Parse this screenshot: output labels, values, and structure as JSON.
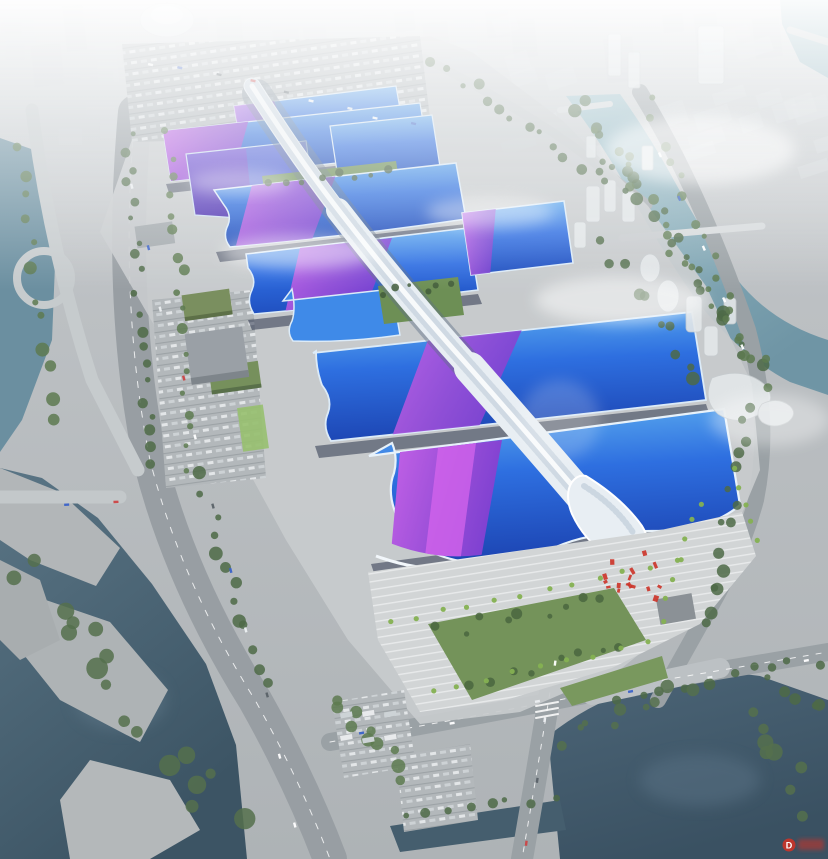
{
  "scene": {
    "description": "aerial rendering of a large exhibition and convention center complex with a sinuous white central concourse spine, rows of blue exhibition hall roofs with purple ribbon bands, surrounding roads, rivers, parks and a hazy city skyline",
    "watermark": {
      "logo_letter": "D"
    }
  },
  "palette": {
    "haze_white": "#f2f4f6",
    "ground": "#b7bbbe",
    "platform": "#c8cbcd",
    "road": "#9aa0a4",
    "road_light": "#c9cdd0",
    "roof_blue": "#2e6fe0",
    "roof_blue_deep": "#1d46b4",
    "roof_cyan": "#57a8ee",
    "roof_purple": "#9a4fd8",
    "roof_magenta": "#c763e8",
    "roof_indigo": "#5b3cc8",
    "spine_white": "#edf2f6",
    "spine_shade": "#aebdcb",
    "water_teal": "#7fa7b4",
    "water_mid": "#5f8295",
    "water_dark": "#415a6b",
    "tree_green": "#4e6a46",
    "lawn_green": "#7b9a60",
    "palm_green": "#85b152",
    "slot_dark": "#1e2740",
    "watermark_red": "#cc3328"
  }
}
